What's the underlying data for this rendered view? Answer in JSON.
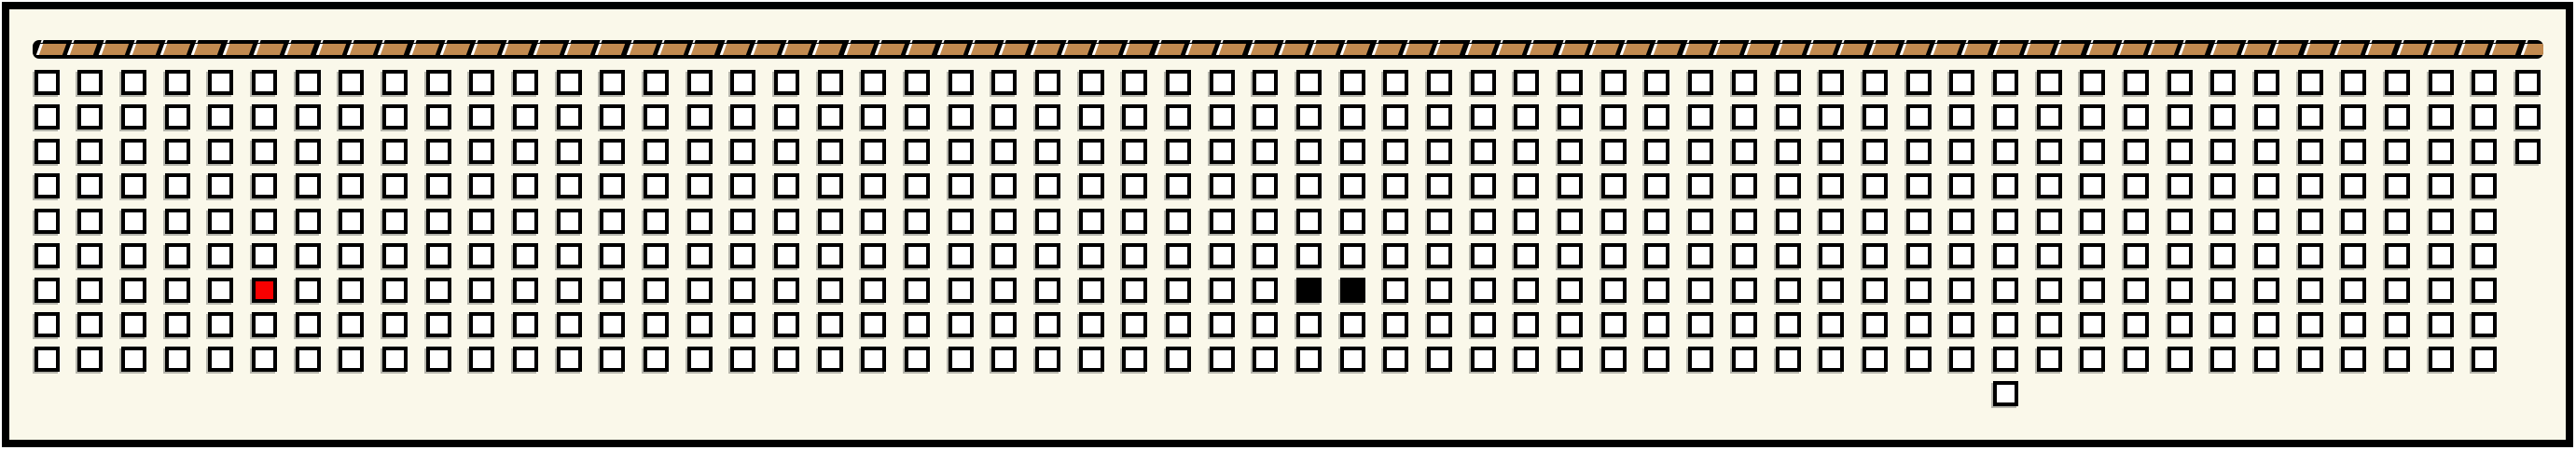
{
  "colors": {
    "page_bg": "#ffffff",
    "panel_bg": "#faf8ea",
    "outline": "#000000",
    "square_fill": "#ffffff",
    "square_shadow": "#b5b5ac",
    "highlight_red": "#f80000",
    "filled_black": "#000000",
    "tape_bar": "#000000",
    "tape_fill": "#c28a50",
    "tape_slash": "#ffffff"
  },
  "tape": {
    "segment_count": 81
  },
  "grid": {
    "row_count": 10,
    "column_count_max": 58,
    "row_column_counts": [
      58,
      58,
      58,
      57,
      57,
      57,
      57,
      57,
      57,
      0
    ],
    "extra_squares": [
      {
        "row": 9,
        "col": 45
      }
    ],
    "colored_squares": [
      {
        "row": 6,
        "col": 5,
        "color_key": "highlight_red"
      },
      {
        "row": 6,
        "col": 29,
        "color_key": "filled_black"
      },
      {
        "row": 6,
        "col": 30,
        "color_key": "filled_black"
      }
    ],
    "white_square_total": 514
  }
}
